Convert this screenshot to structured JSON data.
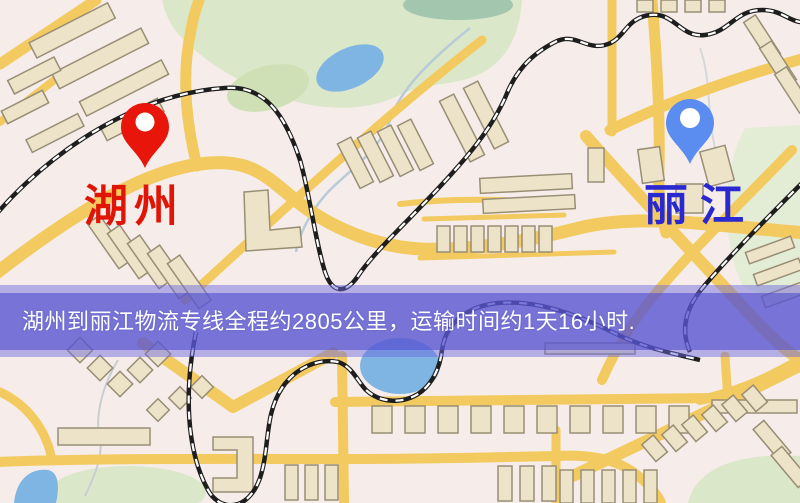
{
  "map": {
    "origin_marker": {
      "label": "湖州",
      "pin_color": "#e8150a",
      "label_color": "#e01505"
    },
    "destination_marker": {
      "label": "丽江",
      "pin_color": "#5b8df0",
      "label_color": "#2a28d0"
    },
    "theme": {
      "background": "#f6edea",
      "road": "#f2ca5f",
      "building_fill": "#ece3c8",
      "building_stroke": "#998e75",
      "park": "#dbe7c9",
      "water": "#7fb5e2",
      "railway": "#1e1e1e",
      "railway_dash": "#ffffff"
    }
  },
  "banner": {
    "text": "湖州到丽江物流专线全程约2805公里，运输时间约1天16小时.",
    "background": "#5450ce",
    "text_color": "#ffffff"
  }
}
